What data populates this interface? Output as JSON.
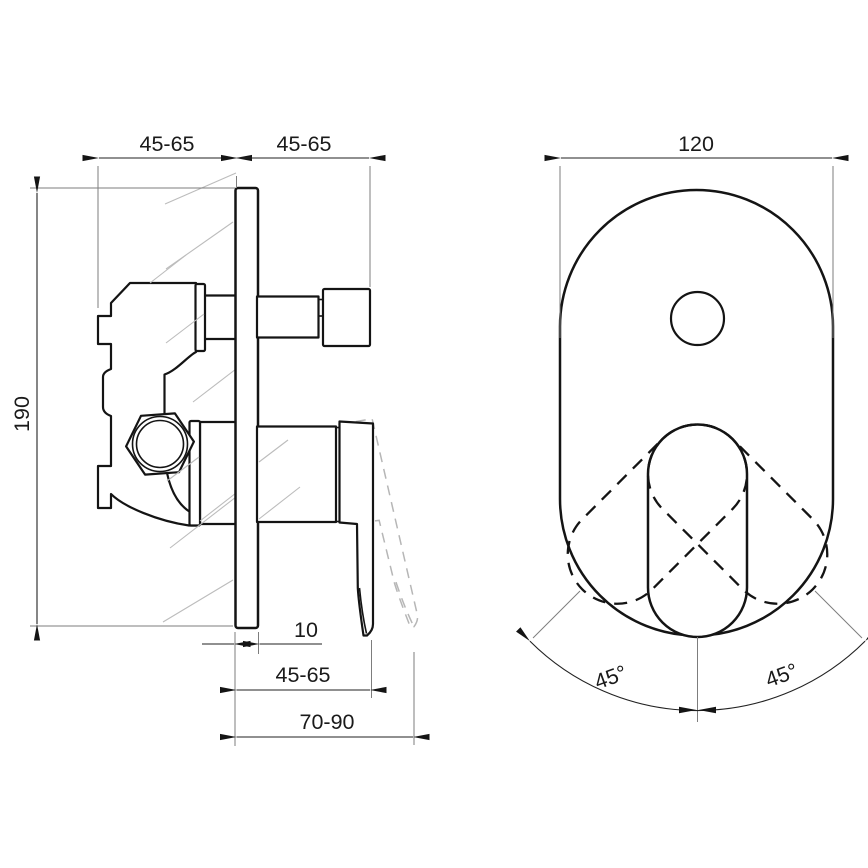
{
  "side_view": {
    "dim_top_left": "45-65",
    "dim_top_right": "45-65",
    "dim_height": "190",
    "dim_plate_thickness": "10",
    "dim_bottom_depth": "45-65",
    "dim_bottom_total": "70-90"
  },
  "front_view": {
    "dim_width": "120",
    "dim_angle_left": "45°",
    "dim_angle_right": "45°"
  },
  "colors": {
    "outline": "#141414",
    "dimension": "#222222",
    "extension": "#7d7d7d",
    "ghost": "#b6b6b6",
    "background": "#ffffff"
  }
}
